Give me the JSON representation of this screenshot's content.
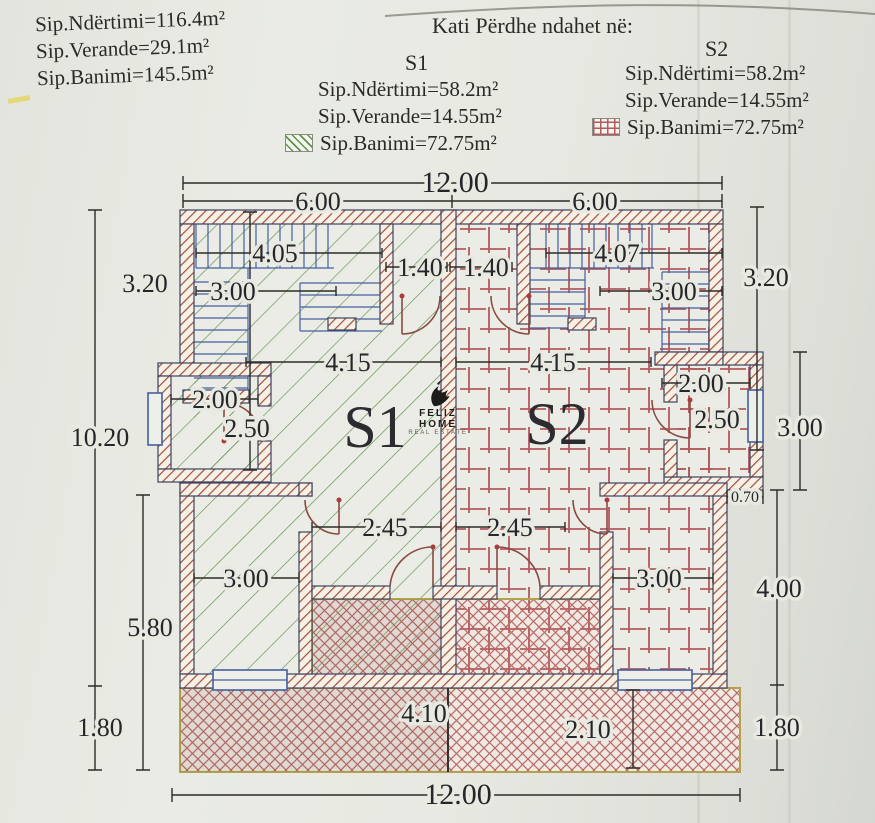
{
  "header": {
    "totals": {
      "line1": "Sip.Ndërtimi=116.4m²",
      "line2": "Sip.Verande=29.1m²",
      "line3": "Sip.Banimi=145.5m²"
    },
    "title": "Kati Përdhe ndahet në:",
    "s1": {
      "name": "S1",
      "line1": "Sip.Ndërtimi=58.2m²",
      "line2": "Sip.Verande=14.55m²",
      "line3": "Sip.Banimi=72.75m²"
    },
    "s2": {
      "name": "S2",
      "line1": "Sip.Ndërtimi=58.2m²",
      "line2": "Sip.Verande=14.55m²",
      "line3": "Sip.Banimi=72.75m²"
    }
  },
  "logo": {
    "name": "FELIZ HOME",
    "tagline": "REAL ESTATE"
  },
  "plan": {
    "units": {
      "s1": "S1",
      "s2": "S2"
    },
    "dims": {
      "top_total": "12.00",
      "top_left": "6.00",
      "top_right": "6.00",
      "bottom_total": "12.00",
      "left_upper": "3.20",
      "left_total": "10.20",
      "left_lower": "5.80",
      "left_veranda": "1.80",
      "right_upper": "3.20",
      "right_wc": "3.00",
      "right_lower": "4.00",
      "right_veranda": "1.80",
      "right_step": "0.70",
      "stair_left_w": "4.05",
      "stair_left_d": "3.00",
      "entry_left": "1.40",
      "entry_right": "1.40",
      "stair_right_w": "4.07",
      "stair_right_d": "3.00",
      "living_left": "4.15",
      "living_right": "4.15",
      "wc_left_w": "2.00",
      "wc_left_d": "2.50",
      "wc_right_w": "2.00",
      "wc_right_d": "2.50",
      "hall_left": "2.45",
      "hall_right": "2.45",
      "room_left": "3.00",
      "room_right": "3.00",
      "veranda_s1": "4.10",
      "veranda_s2": "2.10"
    },
    "colors": {
      "wall_hatch": "#a0503a",
      "unit1_hatch": "#63904e",
      "unit2_grid": "#b35a5e",
      "stairs": "#44609f",
      "veranda_hatch": "#b96a64",
      "veranda_border": "#b3a24a",
      "paper": "#e6e8e1",
      "ink": "#2a2a26"
    }
  }
}
